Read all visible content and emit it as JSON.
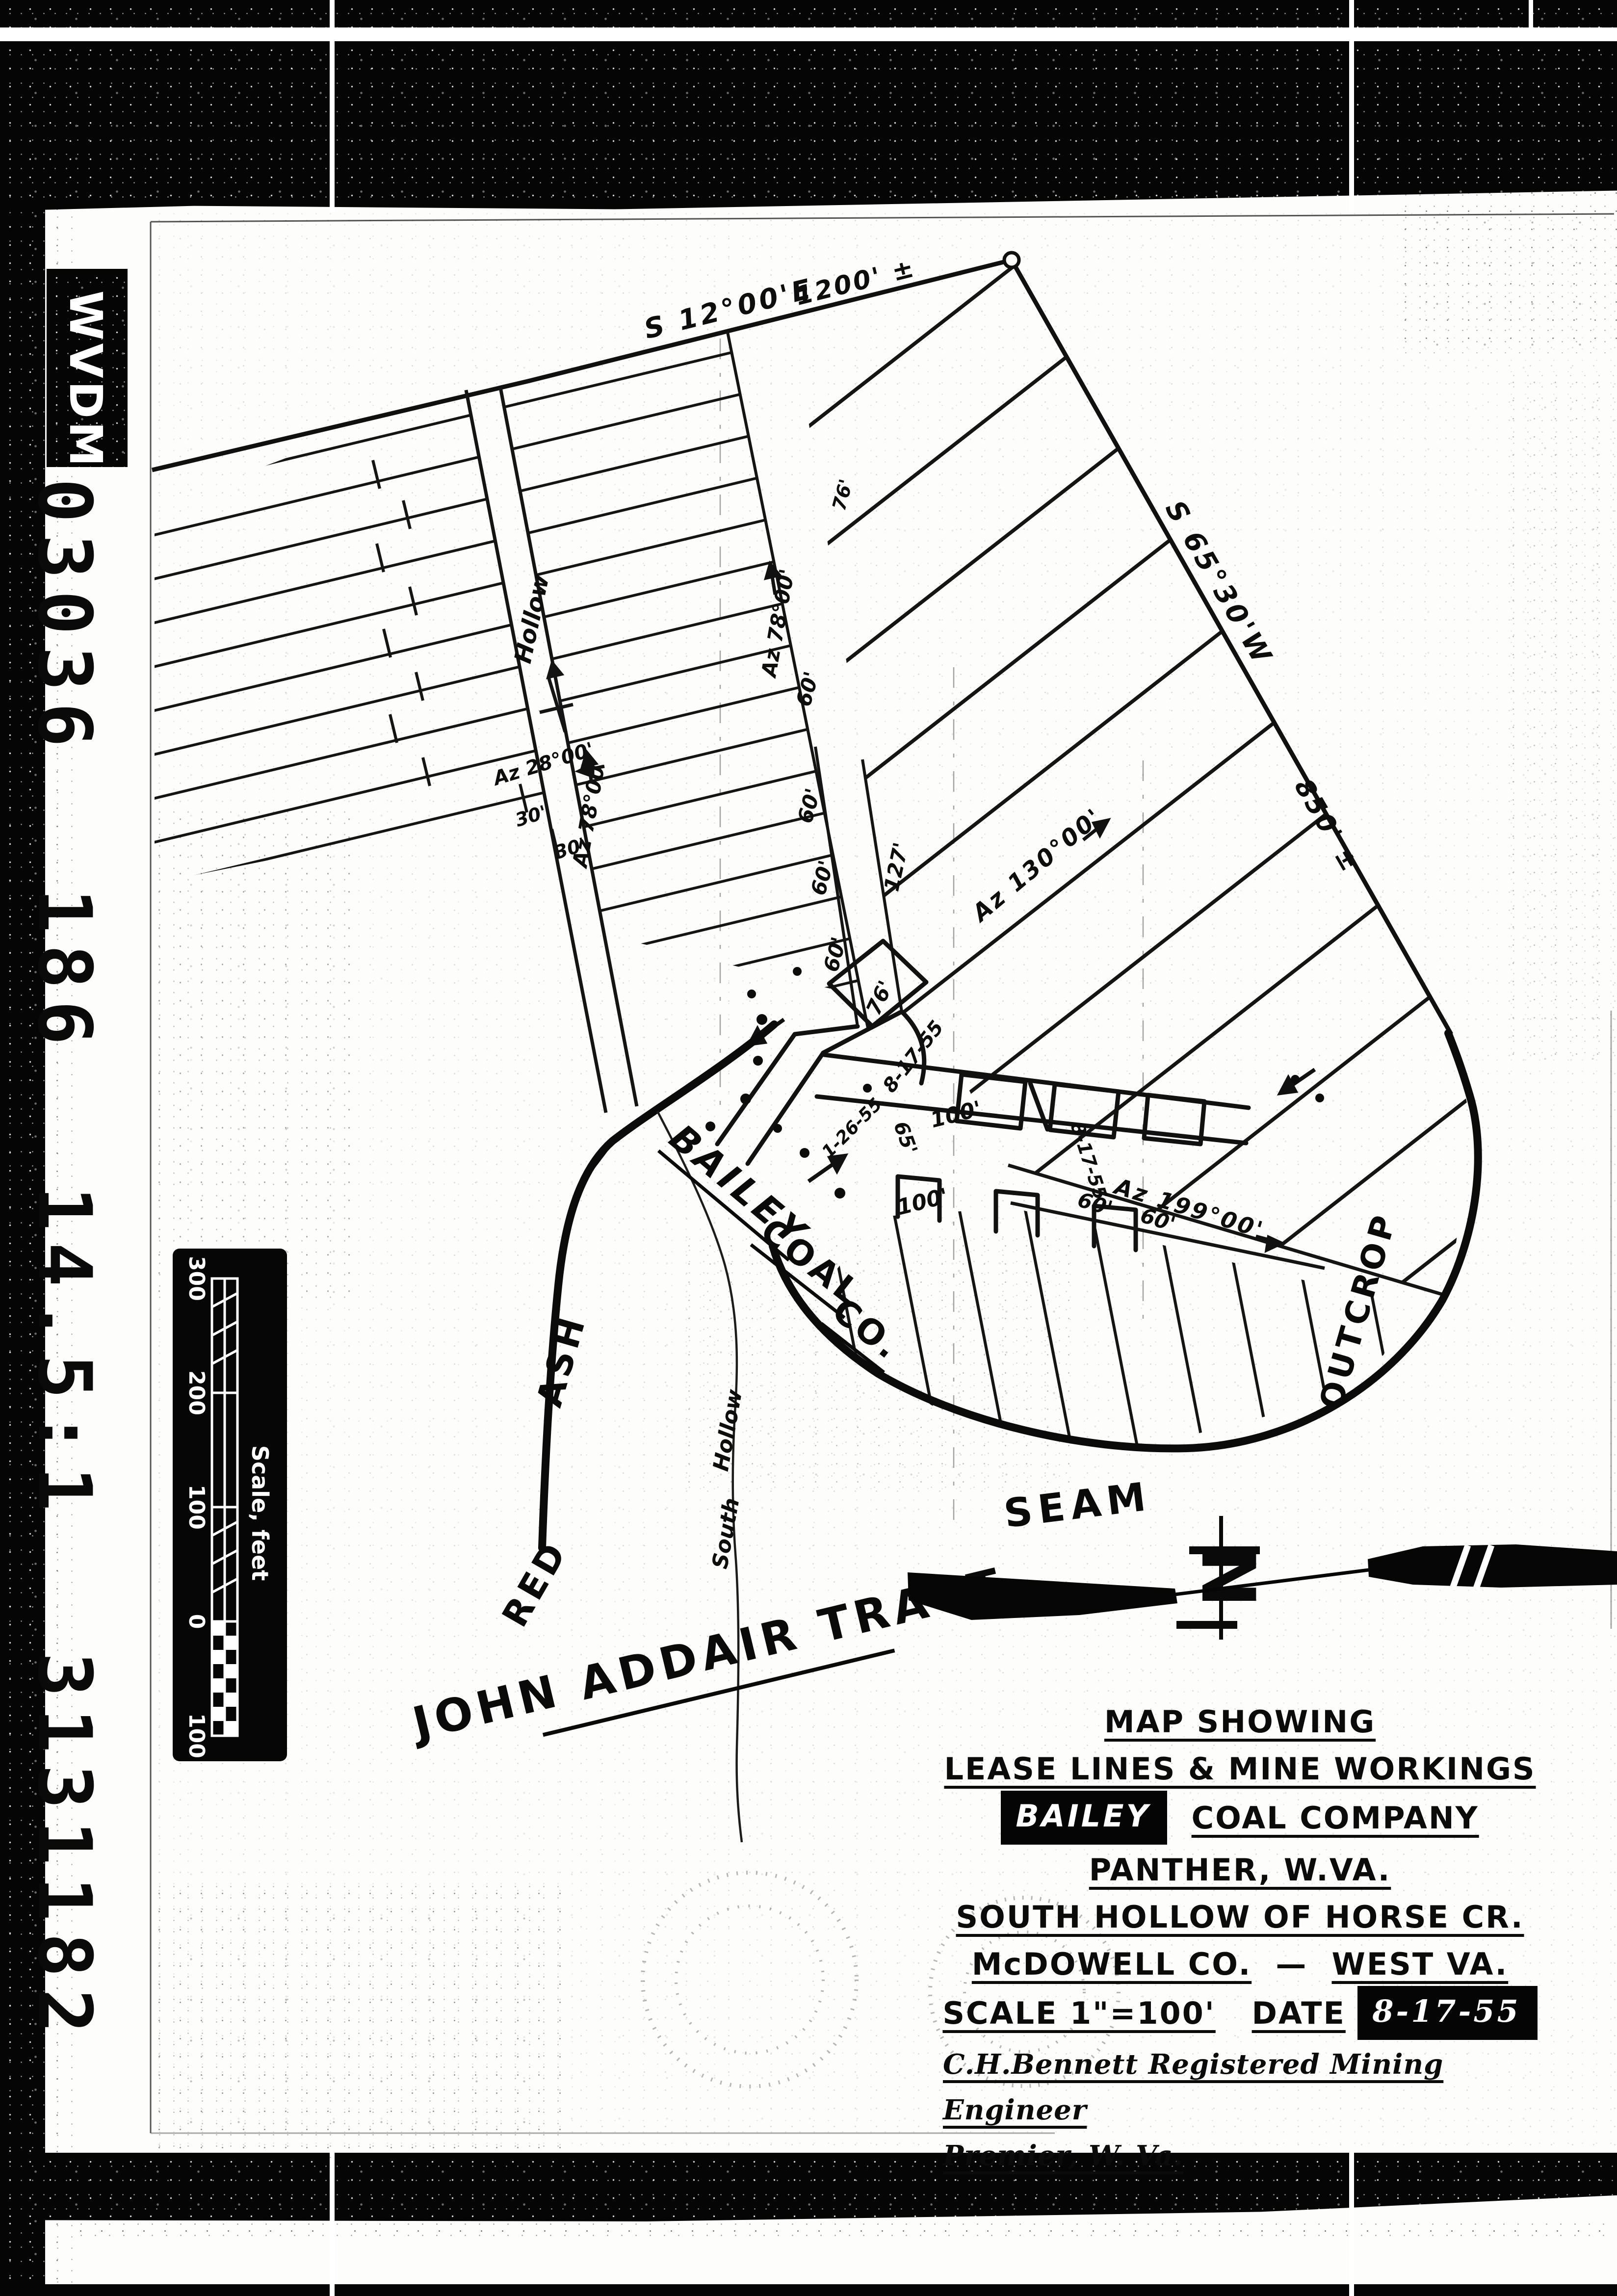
{
  "film": {
    "archive_label": "WVDM",
    "film_number": "03036 186 14.5:1 3131182"
  },
  "scale_bar": {
    "tick_300": "300",
    "tick_200": "200",
    "tick_100": "100",
    "tick_0": "0",
    "tick_b100": "100",
    "caption": "Scale, feet"
  },
  "survey": {
    "bearing_top": "S 12°00'E",
    "dist_top": "1200' ±",
    "bearing_right": "S 65°30'W",
    "dist_right": "850' ±",
    "az_130": "Az 130°00'",
    "az_199": "Az 199°00'",
    "az_78": "Az 78°00'",
    "az_28": "Az 28°00'"
  },
  "dims": {
    "d60": "60'",
    "d30": "30'",
    "d100": "100'",
    "d127": "127'",
    "d76": "76'",
    "d65": "65'"
  },
  "dates": {
    "survey_date": "8-17-55",
    "face_date": "1-26-55"
  },
  "features": {
    "hollow_centerline": "Hollow",
    "stream_word_south": "South",
    "stream_word_hollow": "Hollow",
    "seam_word_red": "RED",
    "seam_word_ash": "ASH",
    "seam": "SEAM",
    "outcrop": "OUTCROP",
    "company_word_1": "BAILEY",
    "company_word_2": "COAL",
    "company_word_3": "CO.",
    "tract": "JOHN ADDAIR TRACT",
    "north": "N"
  },
  "title_block": {
    "line1": "MAP SHOWING",
    "line2": "LEASE LINES & MINE WORKINGS",
    "company_boxed": "BAILEY",
    "line3_rest": "COAL COMPANY",
    "line4": "PANTHER, W.VA.",
    "line5": "SOUTH HOLLOW OF HORSE CR.",
    "line6a": "McDOWELL CO.",
    "line6_dash": "—",
    "line6b": "WEST VA.",
    "line7_scale": "SCALE 1\"=100'",
    "line7_date_label": "DATE",
    "line7_date_boxed": "8-17-55",
    "line8": "C.H.Bennett Registered Mining Engineer",
    "line9": "Premier, W. Va."
  }
}
